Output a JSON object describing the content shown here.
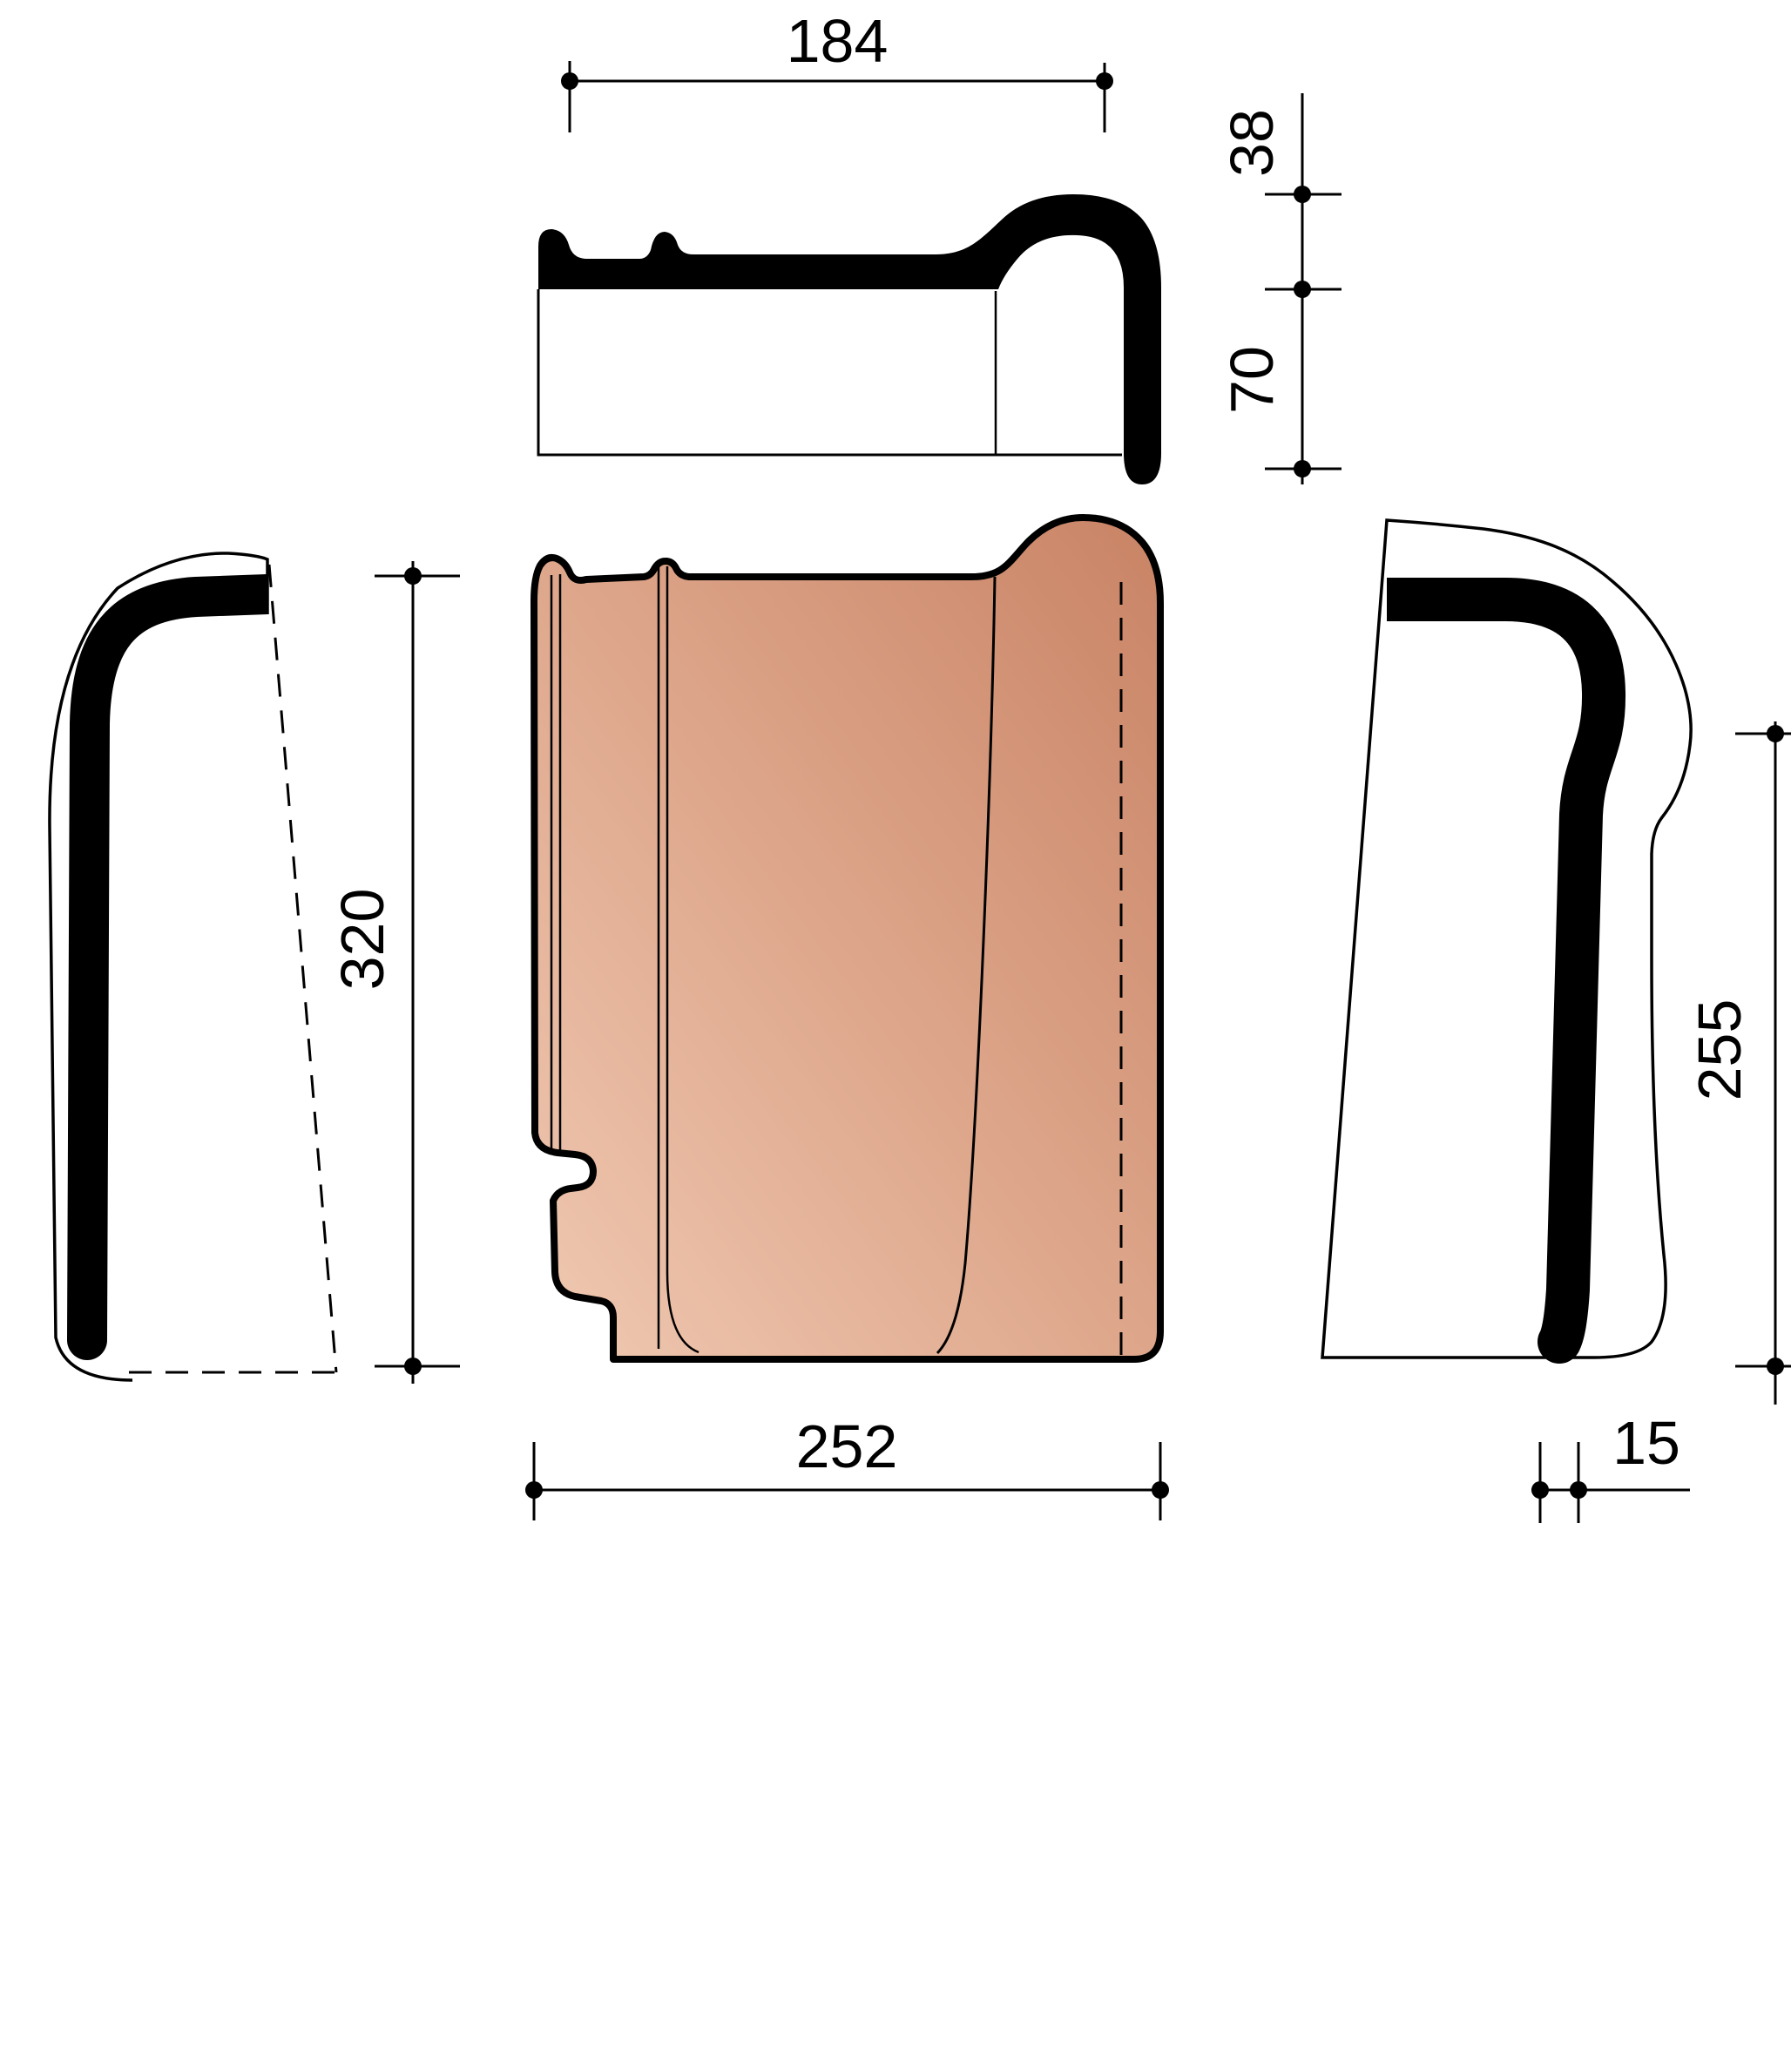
{
  "drawing": {
    "type": "technical-drawing",
    "subject": "interlocking clay roof tile, orthographic views with dimensions",
    "dimensions": {
      "top_width": "184",
      "hook_height": "38",
      "body_height": "70",
      "tile_height": "320",
      "tile_width": "252",
      "side_height": "255",
      "rib_width": "15"
    },
    "colors": {
      "line": "#000000",
      "background": "#ffffff",
      "tile_light": "#f0c9b2",
      "tile_mid": "#dfa98e",
      "tile_dark": "#c98365"
    }
  }
}
